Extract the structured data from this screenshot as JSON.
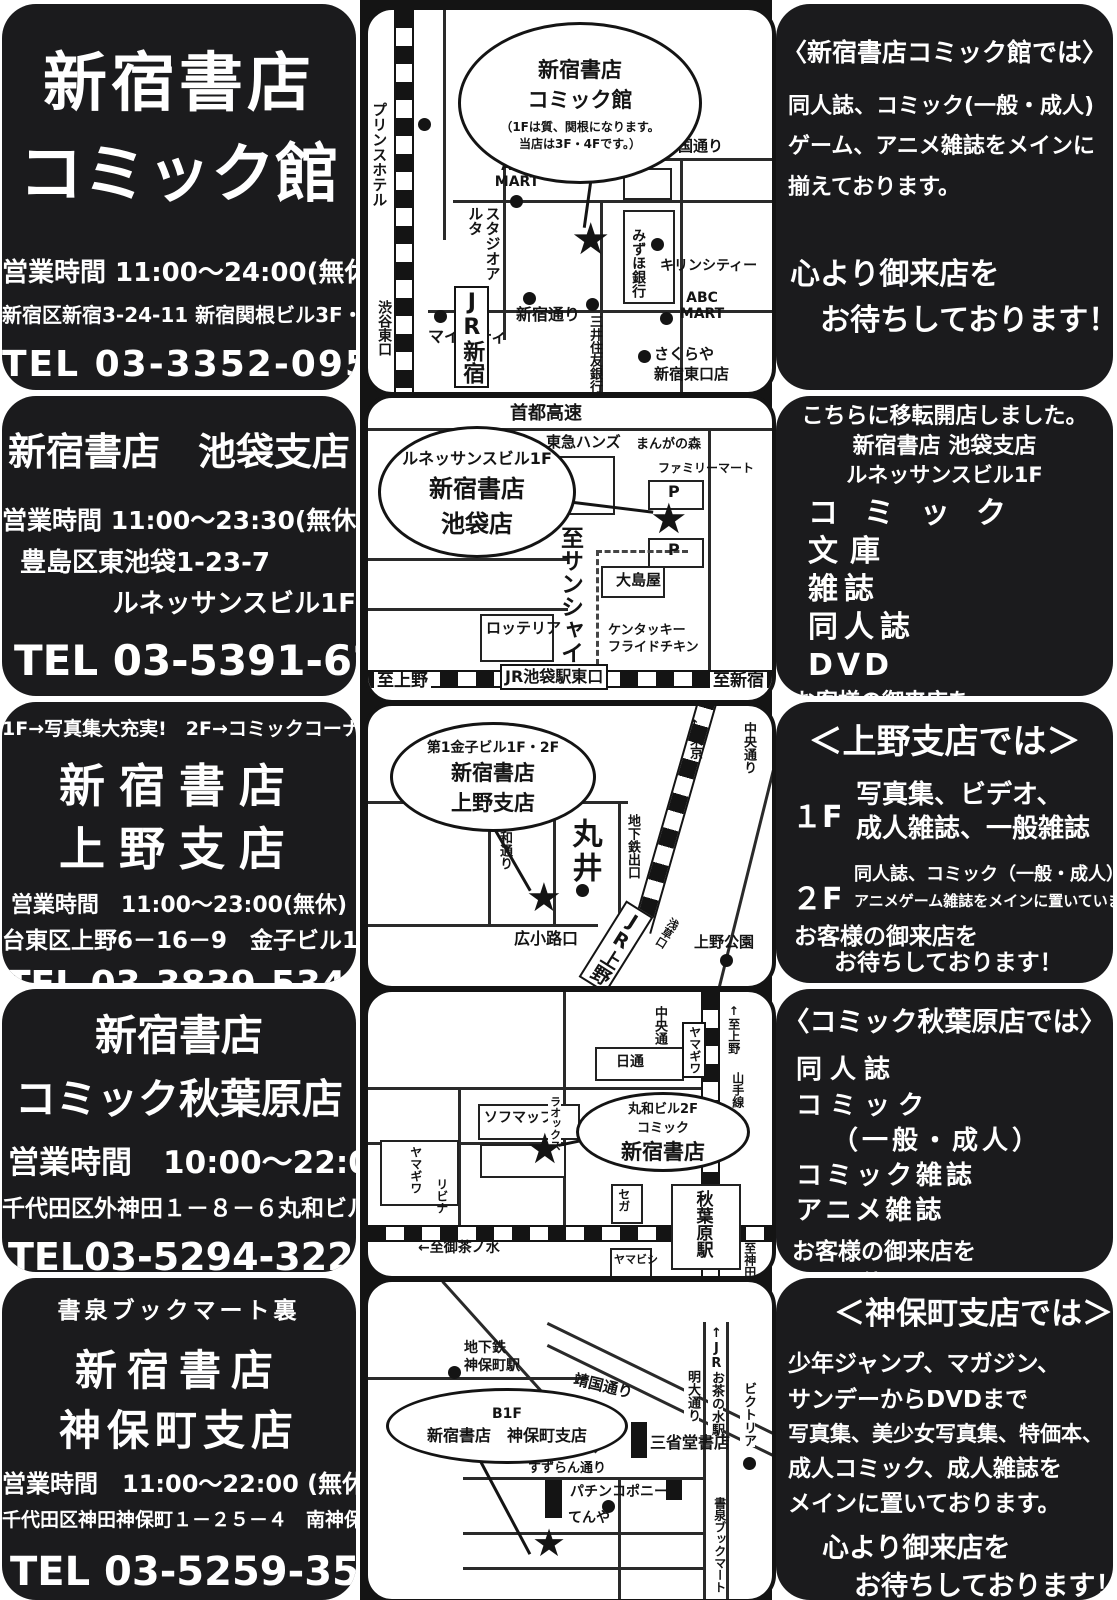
{
  "colors": {
    "background_black": "#1b1b1d",
    "paper_white": "#ffffff",
    "map_ink": "#141414"
  },
  "icons": {
    "star": "★"
  },
  "stores": [
    {
      "id": "comic-kan",
      "info": {
        "name1": "新宿書店",
        "name2": "コミック館",
        "hours": "営業時間  11:00～24:00(無休)",
        "address": "新宿区新宿3-24-11  新宿関根ビル3F・4F",
        "tel": "TEL 03-3352-0952"
      },
      "map": {
        "bubble": [
          "新宿書店",
          "コミック館",
          "（1Fは質、関根になります。",
          "当店は3F・4Fです。）"
        ],
        "labels": {
          "prince_hotel": "プリンスホテル",
          "yasukuni_dori": "靖国通り",
          "abc_mart_1": "ABC MART",
          "studio_alta": "スタジオアルタ",
          "shinjuku_dori": "新宿通り",
          "mitsui_sumitomo_bank": "三井住友銀行",
          "mizuho_bank": "みずほ銀行",
          "kirin_city": "キリンシティー",
          "abc_mart_2": "ABC MART",
          "my_city": "マイシティ",
          "jr_shinjuku": "JR新宿",
          "shibuya_east_exit": "渋谷東口",
          "sakuraya_1": "さくらや",
          "sakuraya_2": "新宿東口店"
        }
      },
      "promo": {
        "heading": "〈新宿書店コミック館では〉",
        "line1": "同人誌、コミック(一般・成人)",
        "line2": "ゲーム、アニメ雑誌をメインに",
        "line3": "揃えております。",
        "closing1": "心より御来店を",
        "closing2": "お待ちしております！"
      }
    },
    {
      "id": "ikebukuro",
      "info": {
        "name": "新宿書店　池袋支店",
        "hours": "営業時間  11:00～23:30(無休)",
        "address1": "豊島区東池袋1-23-7",
        "address2": "ルネッサンスビル1F",
        "tel": "TEL 03-5391-6231"
      },
      "map": {
        "bubble": [
          "ルネッサンスビル1F",
          "新宿書店",
          "池袋店"
        ],
        "labels": {
          "shuto_kosoku": "首都高速",
          "tokyu_hands": "東急ハンズ",
          "manga_no_mori": "まんがの森",
          "family_mart": "ファミリーマート",
          "parking_1": "P",
          "parking_2": "P",
          "to_sunshine": "至サンシャイン",
          "oshimaya": "大島屋",
          "lotteria": "ロッテリア",
          "kfc_1": "ケンタッキー",
          "kfc_2": "フライドチキン",
          "to_ueno": "至上野",
          "jr_ikebukuro_east": "JR池袋駅東口",
          "to_shinjuku": "至新宿"
        }
      },
      "promo": {
        "heading": "こちらに移転開店しました。",
        "sub1": "新宿書店 池袋支店",
        "sub2": "ルネッサンスビル1F",
        "item1": "コミック",
        "item2": "文庫",
        "item3": "雑誌",
        "item4": "同人誌",
        "item5": "DVD",
        "closing1": "お客様の御来店を",
        "closing2": "お待ちしております！"
      }
    },
    {
      "id": "ueno",
      "info": {
        "note": "1F→写真集大充実!　2F→コミックコーナー!",
        "name1": "新宿書店",
        "name2": "上野支店",
        "hours": "営業時間　11:00～23:00(無休)",
        "address": "台東区上野6－16－9　金子ビル1F・2F",
        "tel": "TEL 03-3839-5340"
      },
      "map": {
        "bubble": [
          "第1金子ビル1F・2F",
          "新宿書店",
          "上野支店"
        ],
        "labels": {
          "to_tokyo": "↑東京",
          "chuo_dori": "中央通り",
          "showa_dori": "昭和通り",
          "marui": "丸井",
          "subway_exit": "地下鉄出口",
          "hirokoji_exit": "広小路口",
          "jr_ueno": "JR上野",
          "asakusa_exit": "浅草口",
          "ueno_park": "上野公園"
        }
      },
      "promo": {
        "heading": "＜上野支店では＞",
        "floor1": "１F",
        "floor1_line1": "写真集、ビデオ、",
        "floor1_line2": "成人雑誌、一般雑誌",
        "floor2": "２F",
        "floor2_line1": "同人誌、コミック（一般・成人）、",
        "floor2_line2": "アニメゲーム雑誌をメインに置いています。",
        "closing1": "お客様の御来店を",
        "closing2": "お待ちしております！"
      }
    },
    {
      "id": "akihabara",
      "info": {
        "name1": "新宿書店",
        "name2": "コミック秋葉原店",
        "hours": "営業時間　10:00～22:00",
        "address": "千代田区外神田１－８－６丸和ビル２F",
        "tel": "TEL03-5294-3222"
      },
      "map": {
        "bubble": [
          "丸和ビル2F",
          "コミック",
          "新宿書店"
        ],
        "labels": {
          "chuo_dori": "中央通",
          "yamagiwa_1": "ヤマギワ",
          "to_ueno": "↑至上野",
          "yamanote_line": "山手線",
          "nittsu": "日通",
          "sofmap": "ソフマップ",
          "laox": "ラオックス",
          "yamagiwa_2": "ヤマギワ",
          "livina": "リビナ",
          "sega": "セガ",
          "akihabara_station": "秋葉原駅",
          "to_ochanomizu": "←至御茶ノ水",
          "yamabishi": "ヤマビシ",
          "to_kanda": "至神田↓"
        }
      },
      "promo": {
        "heading": "〈コミック秋葉原店では〉",
        "item1": "同人誌",
        "item2": "コミック",
        "item3": "（一般・成人）",
        "item4": "コミック雑誌",
        "item5": "アニメ雑誌",
        "closing1": "お客様の御来店を",
        "closing2": "お待ちしております！"
      }
    },
    {
      "id": "jimbocho",
      "info": {
        "note": "書泉ブックマート裏",
        "name1": "新宿書店",
        "name2": "神保町支店",
        "hours": "営業時間　11:00～22:00 (無休)",
        "address": "千代田区神田神保町１－２５－４　南神保町ビルB1F",
        "tel": "TEL 03-5259-3525"
      },
      "map": {
        "bubble": [
          "B1F",
          "新宿書店　神保町支店"
        ],
        "labels": {
          "subway_1": "地下鉄",
          "subway_2": "神保町駅",
          "yasukuni_dori": "靖国通り",
          "meidai_dori": "明大通り",
          "jr_ochanomizu": "↑JRお茶の水駅",
          "victoria": "ビクトリア",
          "sanseido": "三省堂書店",
          "suzuran_dori": "すずらん通り",
          "pachinko_pony": "パチンコポニー",
          "tenya": "てんや",
          "shosen_bookmart": "書泉ブックマート"
        }
      },
      "promo": {
        "heading": "＜神保町支店では＞",
        "line1": "少年ジャンプ、マガジン、",
        "line2": "サンデーからDVDまで",
        "line3": "写真集、美少女写真集、特価本、",
        "line4": "成人コミック、成人雑誌を",
        "line5": "メインに置いております。",
        "closing1": "心より御来店を",
        "closing2": "お待ちしております！"
      }
    }
  ]
}
